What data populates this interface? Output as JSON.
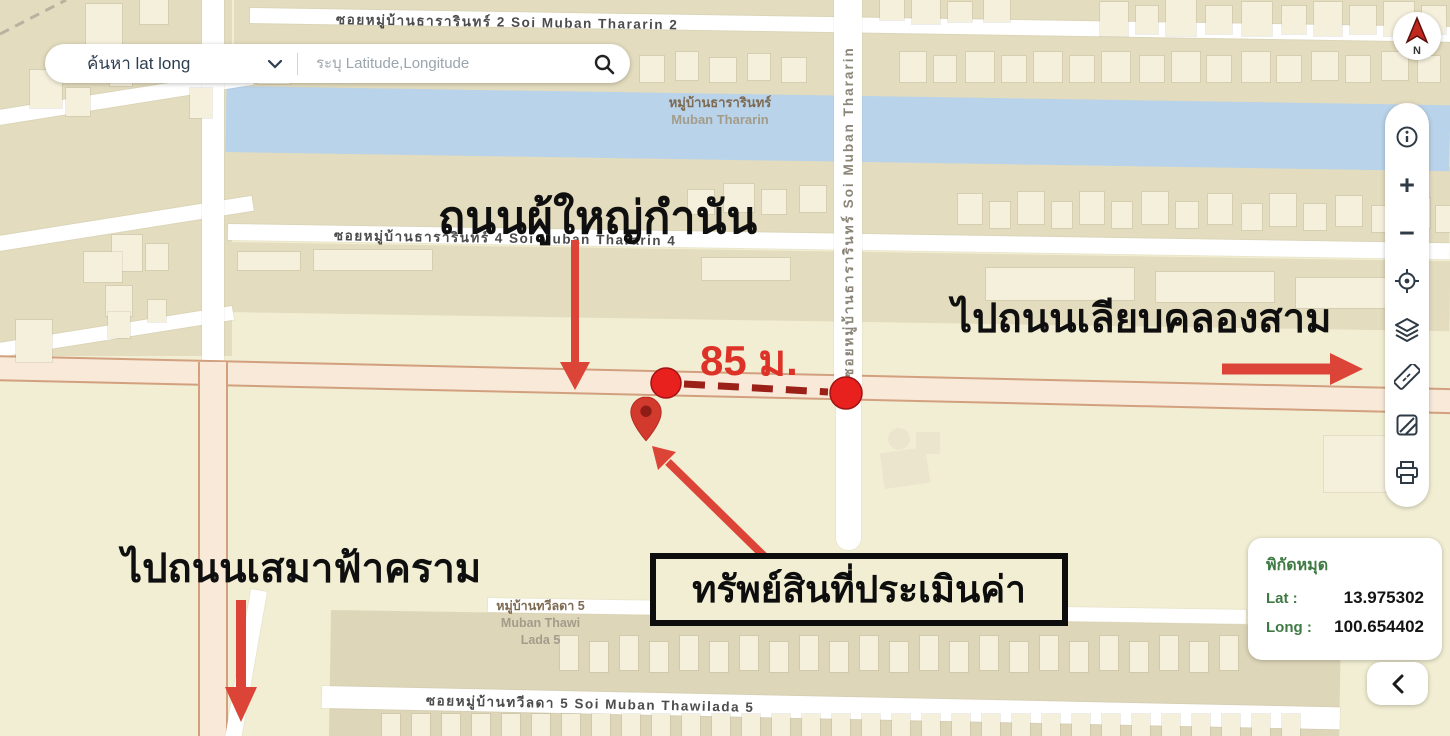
{
  "search": {
    "dropdown_label": "ค้นหา lat long",
    "placeholder": "ระบุ Latitude,Longitude"
  },
  "compass": {
    "letter": "N"
  },
  "toolbar": {
    "zoom_in_glyph": "+",
    "zoom_out_glyph": "−",
    "items": [
      "info",
      "zoom-in",
      "zoom-out",
      "locate",
      "layers",
      "measure",
      "basemap",
      "print"
    ]
  },
  "coords_panel": {
    "title": "พิกัดหมุด",
    "lat_label": "Lat :",
    "lat_value": "13.975302",
    "long_label": "Long :",
    "long_value": "100.654402"
  },
  "annotations": {
    "road_main_name": "ถนนผู้ใหญ่กำนัน",
    "distance": "85 ม.",
    "property_box": "ทรัพย์สินที่ประเมินค่า",
    "to_road_right": "ไปถนนเลียบคลองสาม",
    "to_road_left": "ไปถนนเสมาฟ้าคราม"
  },
  "map_labels": {
    "road_top": "ซอยหมู่บ้านธารารินทร์ 2  Soi Muban Thararin 2",
    "road_4": "ซอยหมู่บ้านธารารินทร์ 4  Soi Muban Thararin 4",
    "road_vertical": "ซอยหมู่บ้านธารารินทร์  Soi Muban Thararin",
    "road_bottom": "ซอยหมู่บ้านทวีลดา 5  Soi Muban Thawilada 5",
    "village1_line1": "หมู่บ้านธารารินทร์",
    "village1_line2": "Muban Thararin",
    "village2_line1": "หมู่บ้านทวีลดา 5",
    "village2_line2": "Muban Thawi",
    "village2_line3": "Lada 5"
  },
  "marker": {
    "lat": "13.975302",
    "long": "100.654402"
  },
  "colors": {
    "accent_red": "#dc4437",
    "dark_red": "#9b2018",
    "marker_red": "#d23a2e",
    "dot_red": "#e8211f",
    "water_blue": "#b9d3ea",
    "map_bg": "#f2eed3",
    "block_beige": "#e3dcbe",
    "road_peach": "#f8e9d8",
    "road_border": "#d2a07f",
    "label_green": "#3f7a44",
    "annotation_black": "#0f0f0f"
  }
}
